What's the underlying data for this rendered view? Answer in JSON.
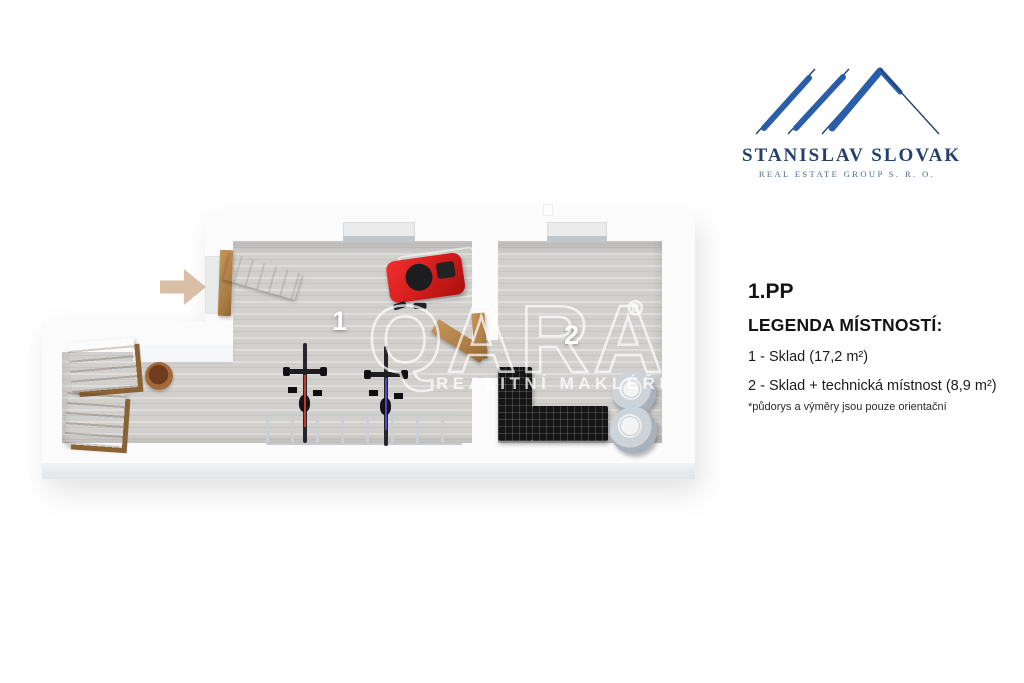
{
  "page": {
    "background": "#ffffff"
  },
  "branding": {
    "logo_icon": "roof-lines-icon",
    "title": "STANISLAV SLOVAK",
    "subtitle": "REAL ESTATE GROUP S. R. O.",
    "colors": {
      "navy": "#23406e",
      "blue": "#2b5ea9"
    }
  },
  "info_panel": {
    "floor_label": "1.PP",
    "legend_title": "LEGENDA MÍSTNOSTÍ:",
    "items": [
      "1 - Sklad (17,2 m²)",
      "2 - Sklad + technická místnost (8,9 m²)"
    ],
    "disclaimer": "*půdorys a výměry jsou pouze orientační"
  },
  "watermark": {
    "brand": "QARA",
    "registered": "®",
    "tagline": "REALITNÍ MAKLÉŘI"
  },
  "floorplan": {
    "rooms": [
      {
        "number": "1"
      },
      {
        "number": "2"
      }
    ],
    "objects": [
      "entrance-arrow-icon",
      "entrance-door",
      "interior-door",
      "wooden-crate",
      "wooden-crate",
      "plant-pot",
      "lawnmower-red",
      "bicycle-red",
      "bicycle-blue",
      "bike-rack",
      "shelving-unit-black",
      "boiler-tank",
      "boiler-tank",
      "window-recess",
      "window-recess"
    ],
    "colors": {
      "floor": "#d1d0cd",
      "wall": "#fbfbfc",
      "arrow_tan": "#d9bfa6",
      "wood": "#b5854f",
      "mower_red": "#d81f1f",
      "shelf_black": "#161616",
      "boiler_gray": "#c3cad1"
    }
  }
}
